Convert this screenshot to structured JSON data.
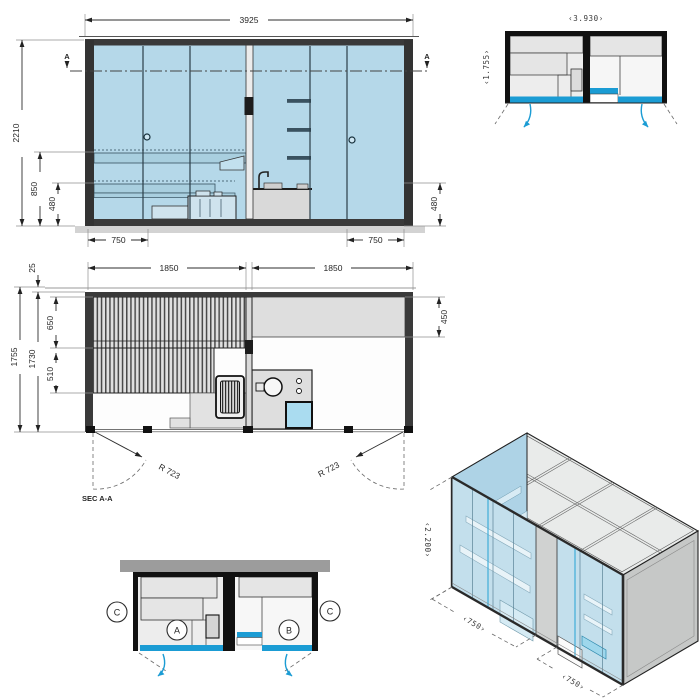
{
  "colors": {
    "accent_cyan": "#1b9cd4",
    "glass_blue": "#b5d8e9",
    "line_dark": "#222222",
    "gray_fill": "#e6e6e6",
    "wall_gray": "#9c9c9c"
  },
  "elevation": {
    "width": "3925",
    "height": "2210",
    "bench_height": "850",
    "seat_height": "480",
    "seat_height_right": "480",
    "door_width_left": "750",
    "door_width_right": "750",
    "section_marker_left": "A",
    "section_marker_right": "A"
  },
  "small_plan": {
    "width": "‹3.930›",
    "depth": "‹1.755›"
  },
  "floor_plan": {
    "bay_left": "1850",
    "bay_right": "1850",
    "roof_overhang": "25",
    "depth_overall": "1755",
    "depth_internal": "1730",
    "bench_depth_upper": "650",
    "bench_depth_lower": "510",
    "counter_depth": "450",
    "door_swing_left": "R 723",
    "door_swing_right": "R 723",
    "section_label": "SEC A-A"
  },
  "section_plan": {
    "room_a": "A",
    "room_b": "B",
    "marker_left": "C",
    "marker_right": "C"
  },
  "isometric": {
    "height": "‹2.200›",
    "bay_left": "‹750›",
    "bay_right": "‹750›"
  }
}
